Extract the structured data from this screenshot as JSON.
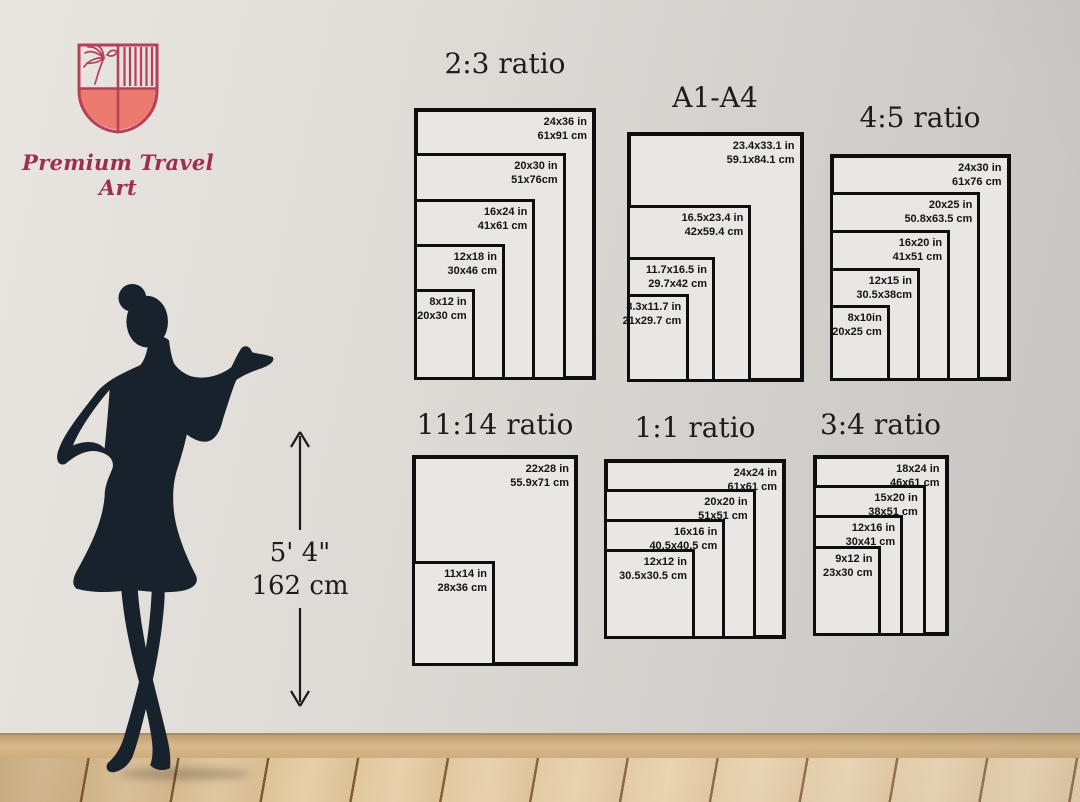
{
  "brand": {
    "name": "Premium Travel Art"
  },
  "height_reference": {
    "feet": "5' 4\"",
    "cm": "162 cm"
  },
  "colors": {
    "shield_fill": "#ed7a6e",
    "shield_stroke": "#b64059",
    "brand_text": "#9e2d52",
    "silhouette": "#17222d",
    "rect_border": "#0e0e0e"
  },
  "charts": [
    {
      "id": "ratio-2-3",
      "title": "2:3 ratio",
      "sizes": [
        {
          "inches": "24x36 in",
          "cm": "61x91 cm",
          "w_in": 24,
          "h_in": 36
        },
        {
          "inches": "20x30 in",
          "cm": "51x76cm",
          "w_in": 20,
          "h_in": 30
        },
        {
          "inches": "16x24 in",
          "cm": "41x61 cm",
          "w_in": 16,
          "h_in": 24
        },
        {
          "inches": "12x18 in",
          "cm": "30x46 cm",
          "w_in": 12,
          "h_in": 18
        },
        {
          "inches": "8x12 in",
          "cm": "20x30 cm",
          "w_in": 8,
          "h_in": 12
        }
      ]
    },
    {
      "id": "a1-a4",
      "title": "A1-A4",
      "sizes": [
        {
          "inches": "23.4x33.1 in",
          "cm": "59.1x84.1 cm",
          "w_in": 23.4,
          "h_in": 33.1
        },
        {
          "inches": "16.5x23.4 in",
          "cm": "42x59.4 cm",
          "w_in": 16.5,
          "h_in": 23.4
        },
        {
          "inches": "11.7x16.5 in",
          "cm": "29.7x42 cm",
          "w_in": 11.7,
          "h_in": 16.5
        },
        {
          "inches": "8.3x11.7 in",
          "cm": "21x29.7 cm",
          "w_in": 8.3,
          "h_in": 11.7
        }
      ]
    },
    {
      "id": "ratio-4-5",
      "title": "4:5 ratio",
      "sizes": [
        {
          "inches": "24x30 in",
          "cm": "61x76 cm",
          "w_in": 24,
          "h_in": 30
        },
        {
          "inches": "20x25 in",
          "cm": "50.8x63.5 cm",
          "w_in": 20,
          "h_in": 25
        },
        {
          "inches": "16x20 in",
          "cm": "41x51 cm",
          "w_in": 16,
          "h_in": 20
        },
        {
          "inches": "12x15 in",
          "cm": "30.5x38cm",
          "w_in": 12,
          "h_in": 15
        },
        {
          "inches": "8x10in",
          "cm": "20x25 cm",
          "w_in": 8,
          "h_in": 10
        }
      ]
    },
    {
      "id": "ratio-11-14",
      "title": "11:14 ratio",
      "sizes": [
        {
          "inches": "22x28 in",
          "cm": "55.9x71 cm",
          "w_in": 22,
          "h_in": 28
        },
        {
          "inches": "11x14 in",
          "cm": "28x36 cm",
          "w_in": 11,
          "h_in": 14
        }
      ]
    },
    {
      "id": "ratio-1-1",
      "title": "1:1 ratio",
      "sizes": [
        {
          "inches": "24x24 in",
          "cm": "61x61 cm",
          "w_in": 24,
          "h_in": 24
        },
        {
          "inches": "20x20 in",
          "cm": "51x51 cm",
          "w_in": 20,
          "h_in": 20
        },
        {
          "inches": "16x16 in",
          "cm": "40.5x40.5 cm",
          "w_in": 16,
          "h_in": 16
        },
        {
          "inches": "12x12 in",
          "cm": "30.5x30.5 cm",
          "w_in": 12,
          "h_in": 12
        }
      ]
    },
    {
      "id": "ratio-3-4",
      "title": "3:4 ratio",
      "sizes": [
        {
          "inches": "18x24 in",
          "cm": "46x61 cm",
          "w_in": 18,
          "h_in": 24
        },
        {
          "inches": "15x20 in",
          "cm": "38x51 cm",
          "w_in": 15,
          "h_in": 20
        },
        {
          "inches": "12x16 in",
          "cm": "30x41 cm",
          "w_in": 12,
          "h_in": 16
        },
        {
          "inches": "9x12 in",
          "cm": "23x30 cm",
          "w_in": 9,
          "h_in": 12
        }
      ]
    }
  ]
}
